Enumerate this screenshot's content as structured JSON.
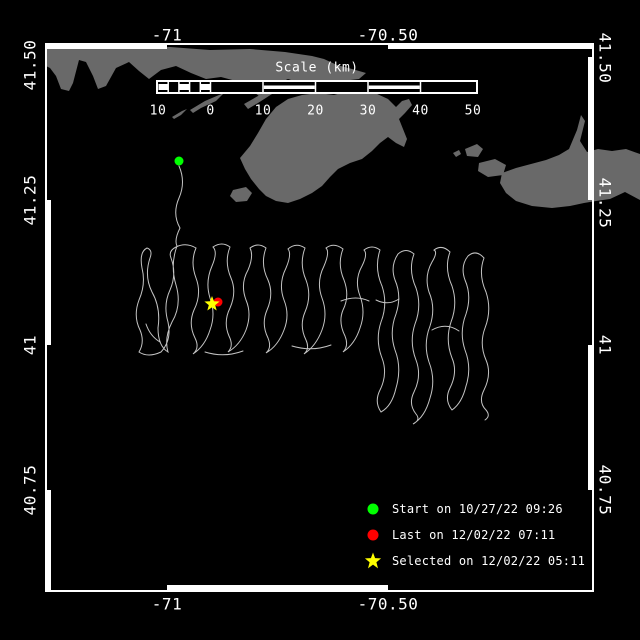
{
  "map": {
    "colors": {
      "background": "#000000",
      "land": "#696969",
      "track": "#c4c4c4",
      "frame": "#ffffff",
      "start_marker": "#00ff00",
      "last_marker": "#ff0000",
      "selected_marker": "#ffff00"
    },
    "axes": {
      "top": [
        "-71",
        "-70.50"
      ],
      "bottom": [
        "-71",
        "-70.50"
      ],
      "left": [
        "41.50",
        "41.25",
        "41",
        "40.75"
      ],
      "right": [
        "41.50",
        "41.25",
        "41",
        "40.75"
      ]
    },
    "scale_bar": {
      "title": "Scale (km)",
      "ticks": [
        "10",
        "0",
        "10",
        "20",
        "30",
        "40",
        "50"
      ]
    },
    "legend": {
      "items": [
        {
          "marker": "circle",
          "color": "#00ff00",
          "label": "Start on 10/27/22 09:26"
        },
        {
          "marker": "circle",
          "color": "#ff0000",
          "label": "Last on 12/02/22 07:11"
        },
        {
          "marker": "star",
          "color": "#ffff00",
          "label": "Selected on 12/02/22 05:11"
        }
      ]
    },
    "markers": {
      "start": {
        "date": "10/27/22 09:26",
        "color": "#00ff00"
      },
      "last": {
        "date": "12/02/22 07:11",
        "color": "#ff0000"
      },
      "selected": {
        "date": "12/02/22 05:11",
        "color": "#ffff00"
      }
    }
  }
}
